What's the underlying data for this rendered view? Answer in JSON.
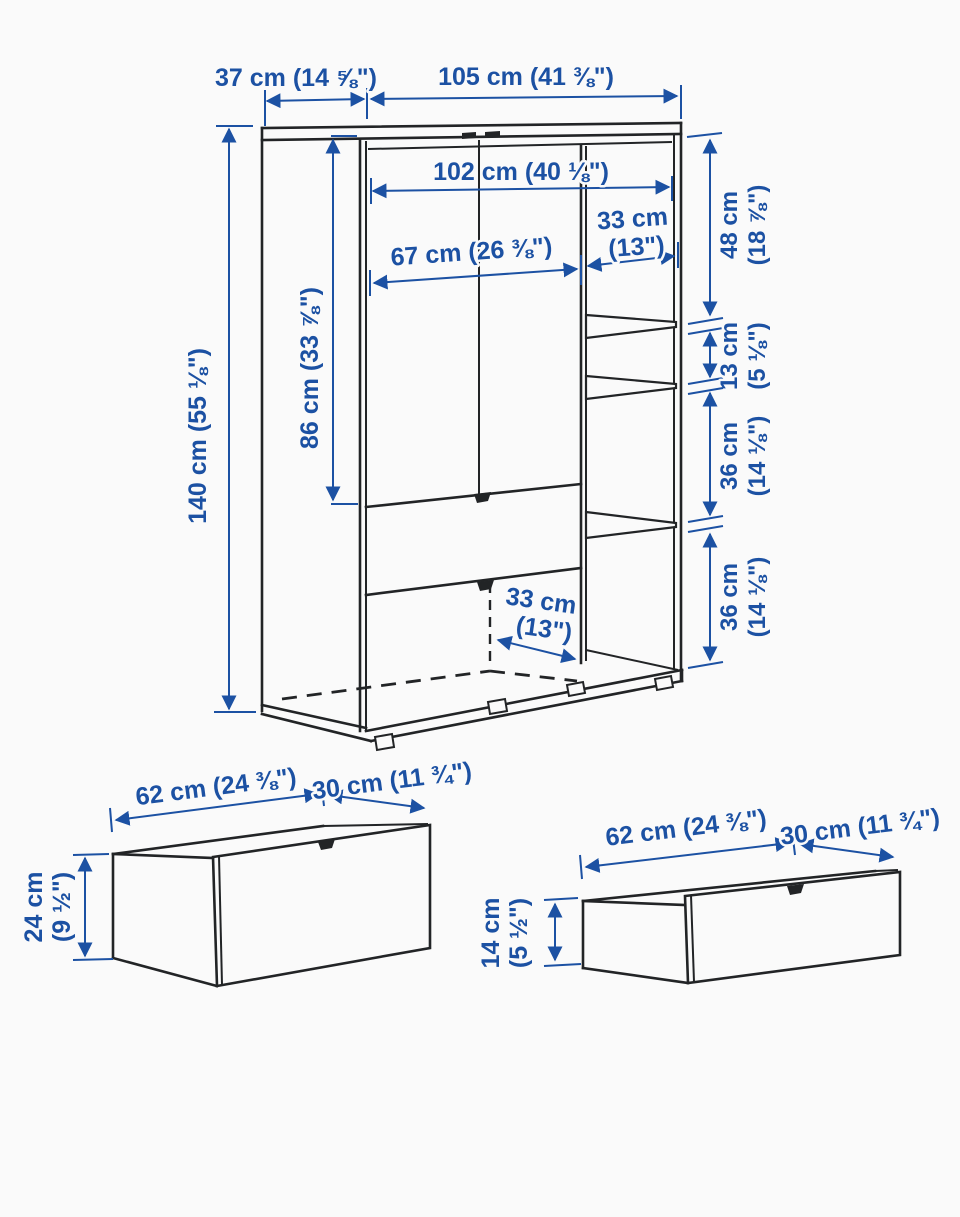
{
  "diagram_title": "wardrobe-dimension-diagram",
  "colors": {
    "dimension_blue": "#1c51a3",
    "line_dark": "#222426",
    "background": "#fafafa"
  },
  "main_unit": {
    "depth_top": "37 cm (14 ⅝\")",
    "width_top": "105 cm (41 ⅜\")",
    "inner_width": "102 cm (40 ⅛\")",
    "left_compartment_width": "67 cm (26 ⅜\")",
    "right_compartment_width": [
      "33 cm",
      "(13\")"
    ],
    "height": "140 cm (55 ⅛\")",
    "door_section_height": "86 cm (33 ⅞\")",
    "right_spacings": [
      [
        "48 cm",
        "(18 ⅞\")"
      ],
      [
        "13 cm",
        "(5 ⅛\")"
      ],
      [
        "36 cm",
        "(14 ⅛\")"
      ],
      [
        "36 cm",
        "(14 ⅛\")"
      ]
    ],
    "interior_depth": [
      "33 cm",
      "(13\")"
    ]
  },
  "large_drawer": {
    "width": "62 cm (24 ⅜\")",
    "depth": "30 cm (11 ¾\")",
    "height": [
      "24 cm",
      "(9 ½\")"
    ]
  },
  "small_drawer": {
    "width": "62 cm (24 ⅜\")",
    "depth": "30 cm (11 ¾\")",
    "height": [
      "14 cm",
      "(5 ½\")"
    ]
  }
}
